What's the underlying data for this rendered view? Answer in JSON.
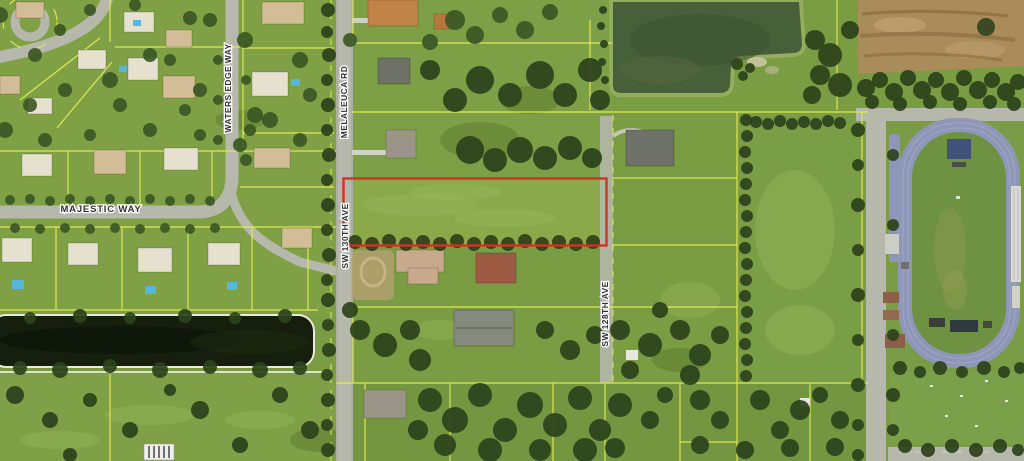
{
  "map": {
    "street_labels": {
      "waters_edge_way": "WATERS EDGE WAY",
      "majestic_way": "MAJESTIC WAY",
      "melaleuca_rd": "MELALEUCA RD",
      "sw_130th_ave": "SW 130TH AVE",
      "sw_128th_ave": "SW 128TH AVE"
    },
    "highlighted_parcel": {
      "outline_color": "#d7301f"
    },
    "colors": {
      "parcel_line": "#e7ec52",
      "road": "#b5b8ab",
      "grass": "#7a9c42",
      "tree": "#2c431c",
      "pond": "#47603a",
      "canal": "#161f0d",
      "track": "#8e97b8",
      "dirt": "#aa8c5a",
      "label_text": "#303030",
      "label_halo": "#ffffff"
    }
  }
}
